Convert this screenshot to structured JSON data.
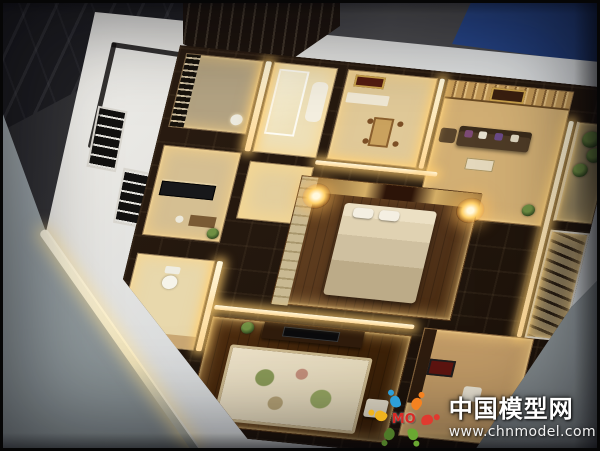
{
  "watermark": {
    "site_name": "中国模型网",
    "site_url": "www.chnmodel.com",
    "logo_text": "MO"
  },
  "palette": {
    "blue_mat": "#2f5ea6",
    "exhibition_floor_gray": "#47474a",
    "marble_floor_dark": "#27272b",
    "platform_white": "#e9e9e6",
    "display_table_gray": "#8e989d",
    "model_wall_brown": "#241810",
    "room_glow_warm": "#ffe2a0",
    "wood_floor_brown": "#5c3b22",
    "logo_blue": "#2e9fd8",
    "logo_orange": "#f58220",
    "logo_red": "#e03a2f",
    "logo_green": "#6aa832",
    "logo_yellow": "#f0b41e",
    "logo_olive": "#4e7a28",
    "watermark_text_color": "#ffffff"
  }
}
